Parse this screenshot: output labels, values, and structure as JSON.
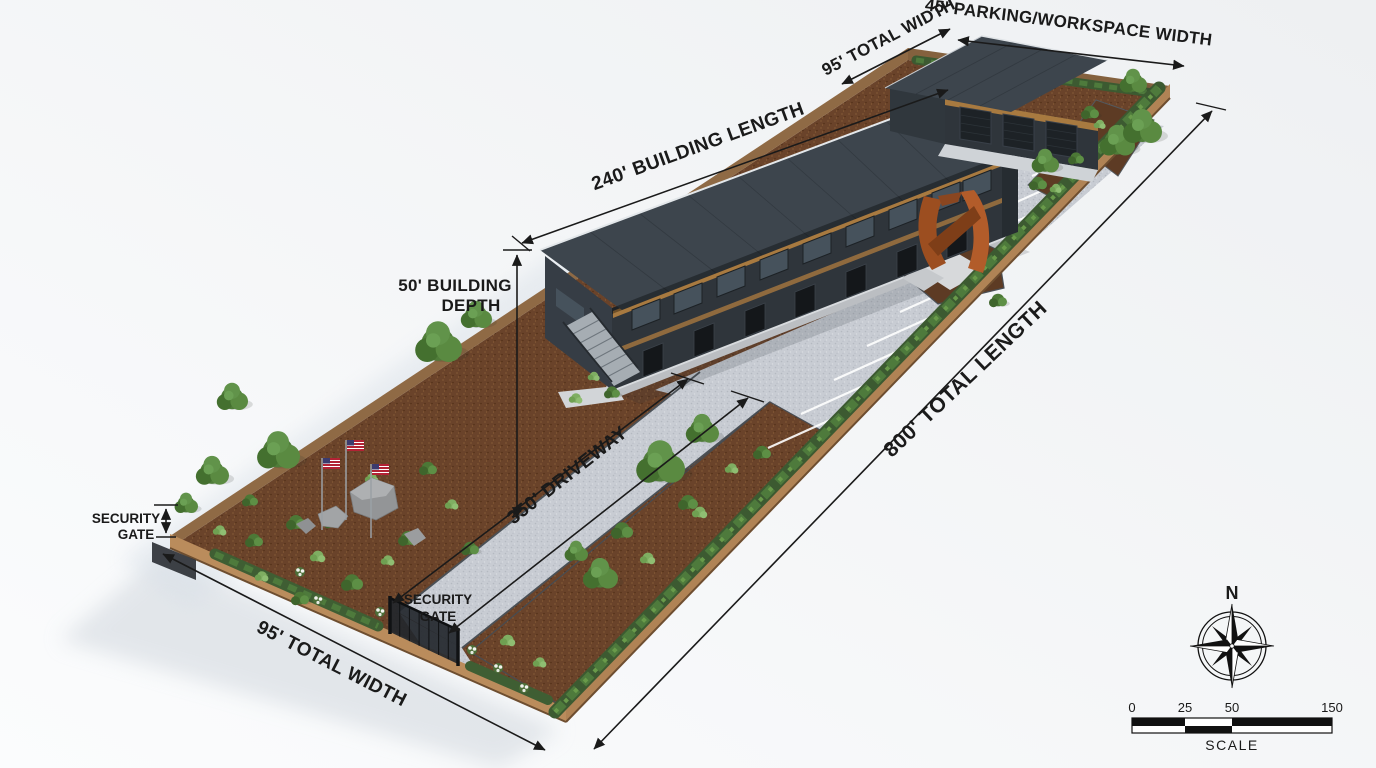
{
  "annotations": {
    "building_length": "240' BUILDING LENGTH",
    "total_width_top": "95' TOTAL WIDTH",
    "parking_workspace_width": "45' PARKING/WORKSPACE WIDTH",
    "building_depth": {
      "line1": "50' BUILDING",
      "line2": "DEPTH"
    },
    "total_length": "800' TOTAL LENGTH",
    "driveway": "350' DRIVEWAY",
    "security_gate_left": {
      "line1": "SECURITY",
      "line2": "GATE"
    },
    "security_gate_middle": {
      "line1": "SECURITY",
      "line2": "GATE"
    },
    "total_width_bottom": "95' TOTAL WIDTH"
  },
  "compass": {
    "north": "N"
  },
  "scale_bar": {
    "ticks": [
      "0",
      "25",
      "50",
      "150"
    ],
    "label": "SCALE"
  },
  "colors": {
    "background": "#f0f2f3",
    "mulch": "#6a432a",
    "gravel": "#c8ccd3",
    "roof": "#3d454d",
    "facade": "#2f353b",
    "wood_accent": "#a87a40",
    "fence": "#b08355",
    "hedge": "#3f5c33",
    "tree": "#4f7c39",
    "concrete": "#d8dbde",
    "sculpture_rust": "#a8551f",
    "parking_stripe": "#ffffff",
    "annotation": "#1a1a1a"
  }
}
